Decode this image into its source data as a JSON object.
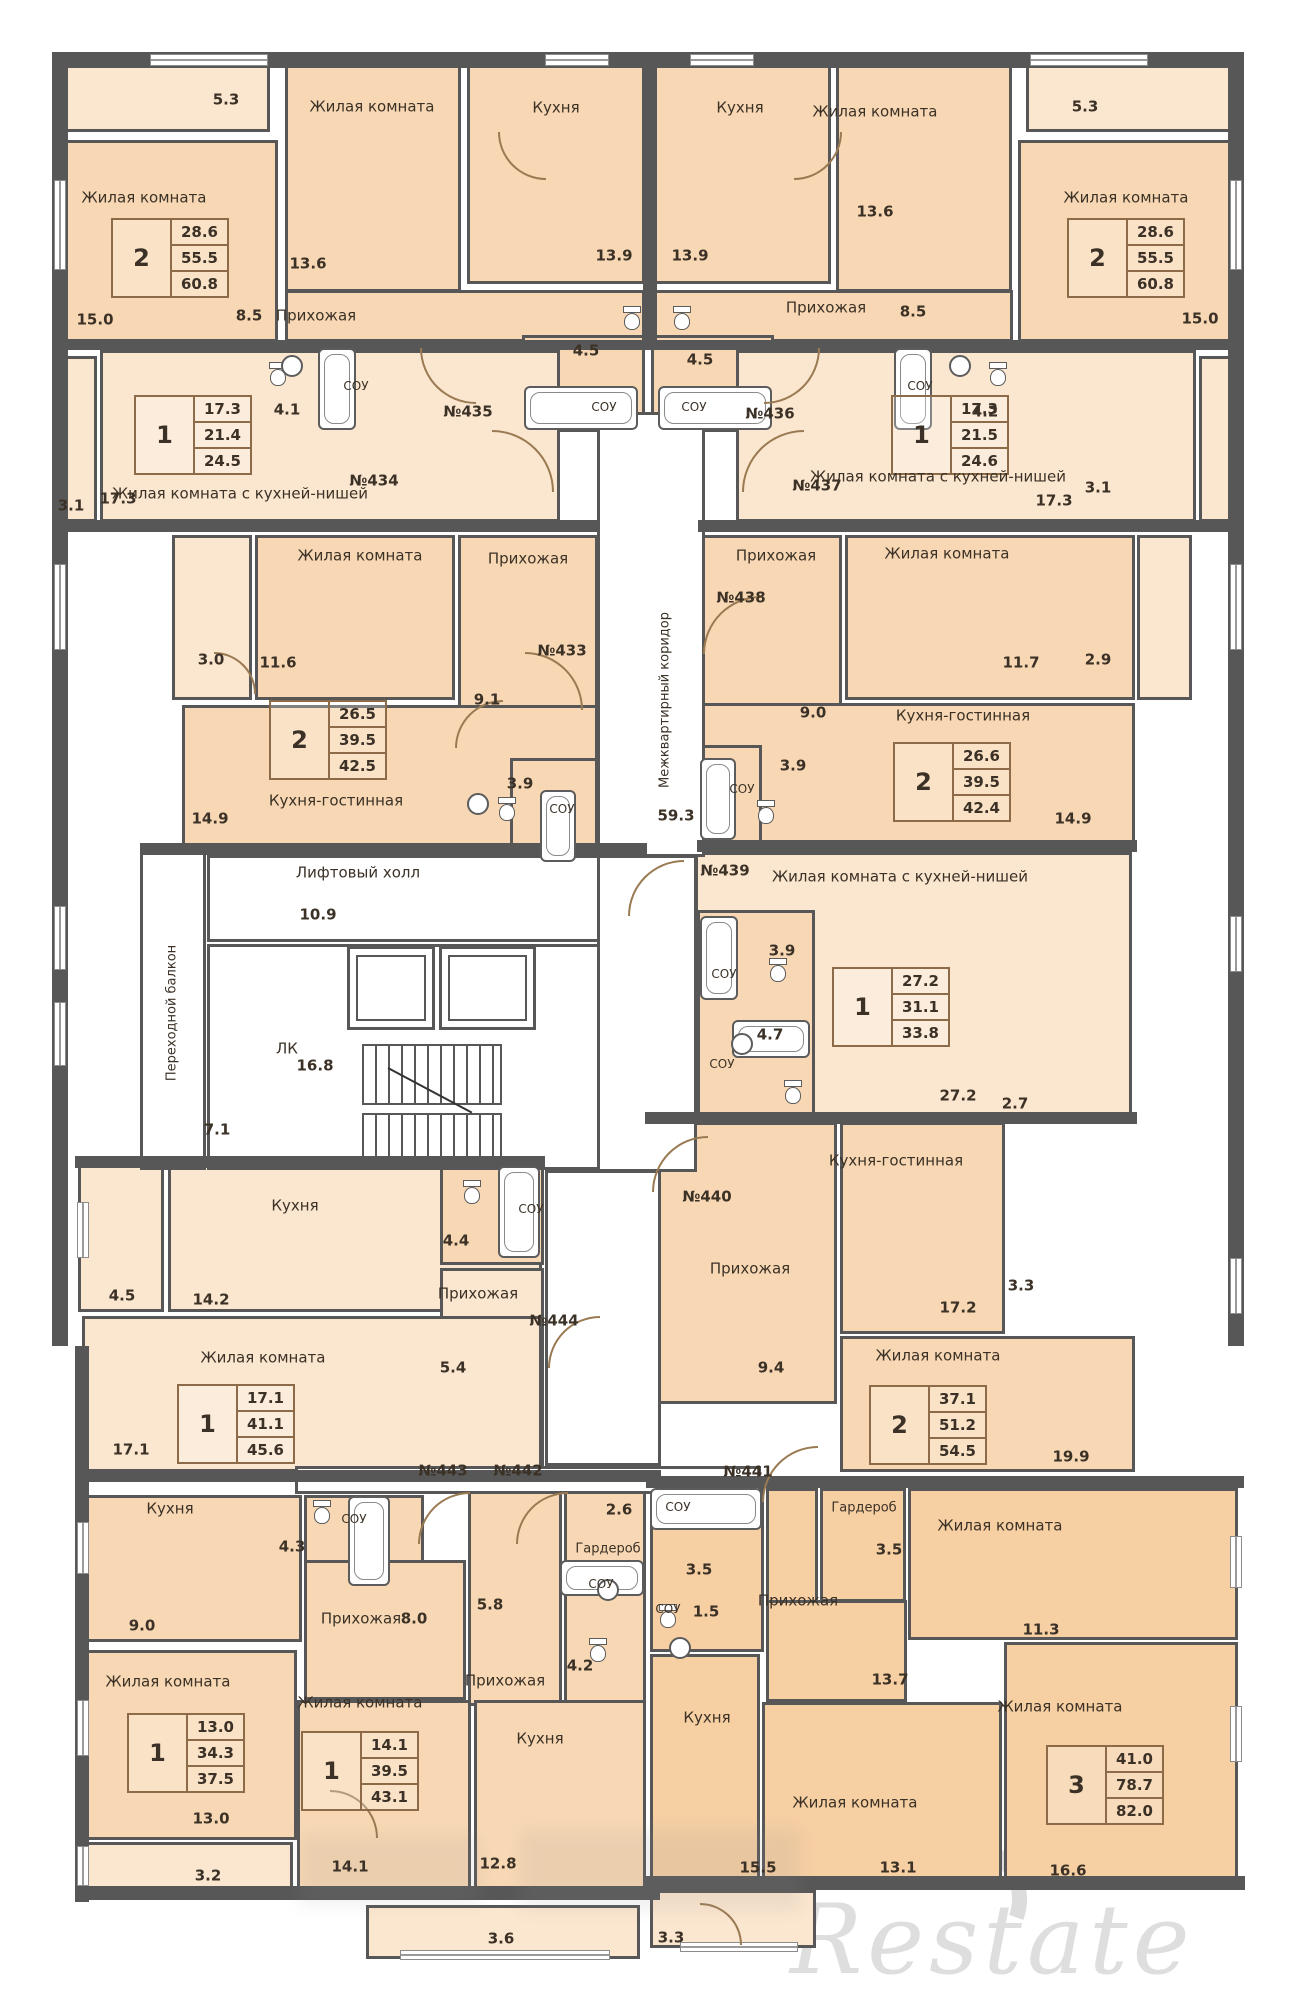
{
  "watermark": {
    "text": "Restate"
  },
  "palette": {
    "room_standard": "#f8d8b4",
    "room_light": "#fbe6cf",
    "room_dark": "#f6cfa3",
    "wall": "#575757",
    "text": "#3b3126",
    "table_border": "#8d6b49",
    "door_arc": "#9a7a52"
  },
  "rooms": [
    [
      "balcony-435",
      62,
      62,
      208,
      70,
      "b"
    ],
    [
      "living2-435",
      62,
      140,
      216,
      202,
      "a"
    ],
    [
      "living-435",
      285,
      62,
      176,
      230,
      "a"
    ],
    [
      "kitchen-435",
      467,
      62,
      178,
      222,
      "a"
    ],
    [
      "hallway-435",
      285,
      290,
      360,
      52,
      "a"
    ],
    [
      "wc-435",
      250,
      348,
      68,
      84,
      "a"
    ],
    [
      "sou-435",
      318,
      348,
      84,
      84,
      "a"
    ],
    [
      "lobby-435",
      402,
      348,
      120,
      84,
      "a"
    ],
    [
      "sou45-435",
      522,
      335,
      123,
      97,
      "a"
    ],
    [
      "kitchen-436",
      653,
      62,
      178,
      222,
      "a"
    ],
    [
      "living-436",
      836,
      62,
      176,
      230,
      "a"
    ],
    [
      "balcony-436",
      1026,
      62,
      208,
      70,
      "b"
    ],
    [
      "living2-436",
      1018,
      140,
      216,
      202,
      "a"
    ],
    [
      "hallway-436",
      653,
      290,
      360,
      52,
      "a"
    ],
    [
      "sou45-436",
      651,
      335,
      123,
      97,
      "a"
    ],
    [
      "lobby-436",
      774,
      348,
      120,
      84,
      "a"
    ],
    [
      "sou-436",
      894,
      348,
      84,
      84,
      "a"
    ],
    [
      "wc-436",
      978,
      348,
      68,
      84,
      "a"
    ],
    [
      "balcony-434",
      55,
      356,
      42,
      166,
      "b"
    ],
    [
      "main-434",
      100,
      350,
      460,
      172,
      "b"
    ],
    [
      "main-437",
      736,
      350,
      460,
      172,
      "b"
    ],
    [
      "balcony-437",
      1199,
      356,
      42,
      166,
      "b"
    ],
    [
      "balcony-433",
      172,
      535,
      80,
      165,
      "b"
    ],
    [
      "living-433",
      255,
      535,
      200,
      165,
      "a"
    ],
    [
      "hallway-433",
      458,
      535,
      140,
      185,
      "a"
    ],
    [
      "kitchenliving-433",
      182,
      705,
      416,
      145,
      "a"
    ],
    [
      "sou-433",
      510,
      758,
      88,
      92,
      "a"
    ],
    [
      "hallway-438",
      700,
      535,
      142,
      185,
      "a"
    ],
    [
      "living-438",
      845,
      535,
      290,
      165,
      "a"
    ],
    [
      "balcony-438",
      1137,
      535,
      55,
      165,
      "b"
    ],
    [
      "kitchenliving-438",
      700,
      703,
      435,
      140,
      "a"
    ],
    [
      "sou-438",
      700,
      745,
      62,
      100,
      "a"
    ],
    [
      "main-439",
      695,
      852,
      437,
      265,
      "b"
    ],
    [
      "souzone-439",
      697,
      910,
      118,
      207,
      "a"
    ],
    [
      "hallway-440",
      650,
      1122,
      187,
      282,
      "a"
    ],
    [
      "kitchenliving-440",
      840,
      1122,
      165,
      212,
      "a"
    ],
    [
      "living-440",
      840,
      1336,
      295,
      136,
      "a"
    ],
    [
      "balcony-444",
      78,
      1165,
      86,
      147,
      "b"
    ],
    [
      "kitchen-444",
      168,
      1165,
      374,
      147,
      "b"
    ],
    [
      "sou-444",
      440,
      1165,
      104,
      100,
      "a"
    ],
    [
      "hallway-444",
      440,
      1268,
      104,
      200,
      "b"
    ],
    [
      "living-444",
      82,
      1316,
      460,
      156,
      "b"
    ],
    [
      "kitchen-443",
      85,
      1495,
      217,
      147,
      "a"
    ],
    [
      "wcsou-443",
      304,
      1495,
      120,
      147,
      "a"
    ],
    [
      "hallway-443",
      304,
      1560,
      162,
      140,
      "a"
    ],
    [
      "living-443",
      85,
      1650,
      212,
      190,
      "a"
    ],
    [
      "balcony-443",
      80,
      1842,
      213,
      52,
      "b"
    ],
    [
      "hallway-442",
      468,
      1490,
      94,
      216,
      "a"
    ],
    [
      "wardrobe-442",
      564,
      1490,
      82,
      216,
      "a"
    ],
    [
      "living-442",
      297,
      1700,
      174,
      196,
      "a"
    ],
    [
      "kitchen-442",
      474,
      1700,
      172,
      196,
      "a"
    ],
    [
      "balcony-442",
      366,
      1905,
      274,
      54,
      "b"
    ],
    [
      "sou-441",
      650,
      1488,
      114,
      164,
      "c"
    ],
    [
      "hallwayA-441",
      766,
      1488,
      52,
      214,
      "c"
    ],
    [
      "wardrobe-441",
      820,
      1488,
      86,
      114,
      "c"
    ],
    [
      "hallwayB-441",
      766,
      1600,
      141,
      102,
      "c"
    ],
    [
      "living113-441",
      908,
      1488,
      330,
      152,
      "c"
    ],
    [
      "living166-441",
      1004,
      1642,
      234,
      244,
      "c"
    ],
    [
      "kitchen-441",
      650,
      1654,
      110,
      232,
      "c"
    ],
    [
      "living131-441",
      762,
      1702,
      240,
      184,
      "c"
    ],
    [
      "balcony-441",
      650,
      1890,
      166,
      58,
      "b"
    ]
  ],
  "whites": [
    [
      "elevator-hall",
      207,
      855,
      440,
      87
    ],
    [
      "stair-room",
      207,
      944,
      440,
      226
    ],
    [
      "transfer-balcony",
      140,
      852,
      66,
      318
    ],
    [
      "corridor-top",
      597,
      412,
      108,
      445
    ],
    [
      "corridor-mid",
      597,
      855,
      100,
      317
    ],
    [
      "corridor-low",
      545,
      1170,
      116,
      296
    ],
    [
      "corridor-strip",
      295,
      1466,
      466,
      28
    ]
  ],
  "walls": [
    [
      52,
      52,
      1192,
      16
    ],
    [
      52,
      52,
      16,
      1294
    ],
    [
      1228,
      52,
      16,
      1294
    ],
    [
      75,
      1346,
      14,
      556
    ],
    [
      75,
      1886,
      585,
      14
    ],
    [
      646,
      1876,
      599,
      14
    ],
    [
      643,
      52,
      14,
      290
    ],
    [
      52,
      340,
      1192,
      10
    ],
    [
      55,
      520,
      545,
      12
    ],
    [
      698,
      520,
      546,
      12
    ],
    [
      140,
      843,
      507,
      12
    ],
    [
      697,
      840,
      440,
      12
    ],
    [
      645,
      1112,
      492,
      12
    ],
    [
      75,
      1156,
      470,
      12
    ],
    [
      75,
      1470,
      586,
      12
    ],
    [
      646,
      1476,
      598,
      12
    ]
  ],
  "windows": [
    [
      150,
      54,
      118,
      12,
      "h"
    ],
    [
      545,
      54,
      64,
      12,
      "h"
    ],
    [
      690,
      54,
      64,
      12,
      "h"
    ],
    [
      1030,
      54,
      118,
      12,
      "h"
    ],
    [
      54,
      180,
      12,
      90,
      "v"
    ],
    [
      54,
      564,
      12,
      86,
      "v"
    ],
    [
      54,
      906,
      12,
      64,
      "v"
    ],
    [
      54,
      1002,
      12,
      64,
      "v"
    ],
    [
      77,
      1202,
      12,
      56,
      "v"
    ],
    [
      77,
      1522,
      12,
      52,
      "v"
    ],
    [
      77,
      1700,
      12,
      56,
      "v"
    ],
    [
      77,
      1846,
      12,
      40,
      "v"
    ],
    [
      1230,
      180,
      12,
      90,
      "v"
    ],
    [
      1230,
      564,
      12,
      86,
      "v"
    ],
    [
      1230,
      916,
      12,
      56,
      "v"
    ],
    [
      1230,
      1258,
      12,
      56,
      "v"
    ],
    [
      1230,
      1536,
      12,
      52,
      "v"
    ],
    [
      1230,
      1706,
      12,
      56,
      "v"
    ],
    [
      400,
      1950,
      210,
      10,
      "h"
    ],
    [
      680,
      1942,
      118,
      10,
      "h"
    ]
  ],
  "labels": [
    [
      "5.3",
      226,
      100
    ],
    [
      "Жилая комната",
      372,
      107
    ],
    [
      "Кухня",
      556,
      108
    ],
    [
      "Жилая комната",
      144,
      198
    ],
    [
      "13.6",
      308,
      264
    ],
    [
      "13.9",
      614,
      256
    ],
    [
      "15.0",
      95,
      320
    ],
    [
      "8.5",
      249,
      316
    ],
    [
      "Прихожая",
      316,
      316
    ],
    [
      "4.5",
      586,
      351
    ],
    [
      "4.1",
      287,
      410
    ],
    [
      "СОУ",
      356,
      386,
      12
    ],
    [
      "СОУ",
      604,
      407,
      12
    ],
    [
      "№435",
      468,
      412
    ],
    [
      "5.3",
      1085,
      107
    ],
    [
      "Кухня",
      740,
      108
    ],
    [
      "Жилая комната",
      875,
      112
    ],
    [
      "Жилая комната",
      1126,
      198
    ],
    [
      "13.9",
      690,
      256
    ],
    [
      "13.6",
      875,
      212
    ],
    [
      "15.0",
      1200,
      319
    ],
    [
      "Прихожая",
      826,
      308
    ],
    [
      "8.5",
      913,
      312
    ],
    [
      "4.5",
      700,
      360
    ],
    [
      "СОУ",
      694,
      407,
      12
    ],
    [
      "№436",
      770,
      414
    ],
    [
      "СОУ",
      920,
      386,
      12
    ],
    [
      "4.2",
      985,
      412
    ],
    [
      "17.3",
      118,
      499
    ],
    [
      "Жилая комната с кухней-нишей",
      240,
      494
    ],
    [
      "3.1",
      71,
      506
    ],
    [
      "№434",
      374,
      481
    ],
    [
      "Жилая комната с кухней-нишей",
      938,
      477
    ],
    [
      "17.3",
      1054,
      501
    ],
    [
      "3.1",
      1098,
      488
    ],
    [
      "№437",
      817,
      486
    ],
    [
      "Жилая комната",
      360,
      556
    ],
    [
      "Прихожая",
      528,
      559
    ],
    [
      "3.0",
      211,
      660
    ],
    [
      "11.6",
      278,
      663
    ],
    [
      "№433",
      562,
      651
    ],
    [
      "9.1",
      487,
      700
    ],
    [
      "Кухня-гостинная",
      336,
      801
    ],
    [
      "14.9",
      210,
      819
    ],
    [
      "3.9",
      520,
      784
    ],
    [
      "СОУ",
      562,
      809,
      12
    ],
    [
      "Прихожая",
      776,
      556
    ],
    [
      "Жилая комната",
      947,
      554
    ],
    [
      "№438",
      741,
      598
    ],
    [
      "11.7",
      1021,
      663
    ],
    [
      "2.9",
      1098,
      660
    ],
    [
      "9.0",
      813,
      713
    ],
    [
      "Кухня-гостинная",
      963,
      716
    ],
    [
      "3.9",
      793,
      766
    ],
    [
      "СОУ",
      742,
      789,
      12
    ],
    [
      "14.9",
      1073,
      819
    ],
    [
      "Лифтовый холл",
      358,
      873
    ],
    [
      "10.9",
      318,
      915
    ],
    [
      "Переходной балкон",
      172,
      1013,
      13,
      -90
    ],
    [
      "ЛК",
      287,
      1049
    ],
    [
      "16.8",
      315,
      1066
    ],
    [
      "7.1",
      217,
      1130
    ],
    [
      "Межквартирный коридор",
      665,
      700,
      13,
      -90
    ],
    [
      "59.3",
      676,
      816
    ],
    [
      "№439",
      725,
      871
    ],
    [
      "Жилая комната с кухней-нишей",
      900,
      877
    ],
    [
      "3.9",
      782,
      951
    ],
    [
      "СОУ",
      724,
      974,
      12
    ],
    [
      "4.7",
      770,
      1035
    ],
    [
      "СОУ",
      722,
      1064,
      12
    ],
    [
      "27.2",
      958,
      1096
    ],
    [
      "2.7",
      1015,
      1104
    ],
    [
      "№440",
      707,
      1197
    ],
    [
      "Кухня-гостинная",
      896,
      1161
    ],
    [
      "Прихожая",
      750,
      1269
    ],
    [
      "3.3",
      1021,
      1286
    ],
    [
      "17.2",
      958,
      1308
    ],
    [
      "9.4",
      771,
      1368
    ],
    [
      "Жилая комната",
      938,
      1356
    ],
    [
      "19.9",
      1071,
      1457
    ],
    [
      "Кухня",
      295,
      1206
    ],
    [
      "4.5",
      122,
      1296
    ],
    [
      "14.2",
      211,
      1300
    ],
    [
      "4.4",
      456,
      1241
    ],
    [
      "СОУ",
      531,
      1209,
      12
    ],
    [
      "Прихожая",
      478,
      1294
    ],
    [
      "№444",
      554,
      1321
    ],
    [
      "5.4",
      453,
      1368
    ],
    [
      "Жилая комната",
      263,
      1358
    ],
    [
      "17.1",
      131,
      1450
    ],
    [
      "№443",
      443,
      1471
    ],
    [
      "№442",
      518,
      1471
    ],
    [
      "№441",
      748,
      1472
    ],
    [
      "Кухня",
      170,
      1509
    ],
    [
      "4.3",
      292,
      1547
    ],
    [
      "СОУ",
      354,
      1519,
      12
    ],
    [
      "9.0",
      142,
      1626
    ],
    [
      "Прихожая",
      361,
      1619
    ],
    [
      "8.0",
      414,
      1619
    ],
    [
      "Жилая комната",
      168,
      1682
    ],
    [
      "13.0",
      211,
      1819
    ],
    [
      "3.2",
      208,
      1876
    ],
    [
      "2.6",
      619,
      1510
    ],
    [
      "Гардероб",
      608,
      1549,
      13
    ],
    [
      "СОУ",
      601,
      1584,
      12
    ],
    [
      "5.8",
      490,
      1605
    ],
    [
      "4.2",
      580,
      1666
    ],
    [
      "Прихожая",
      505,
      1681
    ],
    [
      "Жилая комната",
      360,
      1703
    ],
    [
      "Кухня",
      540,
      1739
    ],
    [
      "14.1",
      350,
      1867
    ],
    [
      "12.8",
      498,
      1864
    ],
    [
      "3.6",
      501,
      1939
    ],
    [
      "СОУ",
      678,
      1507,
      12
    ],
    [
      "3.5",
      699,
      1570
    ],
    [
      "Гардероб",
      864,
      1508,
      13
    ],
    [
      "3.5",
      889,
      1550
    ],
    [
      "Жилая комната",
      1000,
      1526
    ],
    [
      "11.3",
      1041,
      1630
    ],
    [
      "СОУ",
      668,
      1609,
      12
    ],
    [
      "1.5",
      706,
      1612
    ],
    [
      "Прихожая",
      798,
      1601
    ],
    [
      "13.7",
      890,
      1680
    ],
    [
      "Кухня",
      707,
      1718
    ],
    [
      "Жилая комната",
      855,
      1803
    ],
    [
      "13.1",
      898,
      1868
    ],
    [
      "Жилая комната",
      1060,
      1707
    ],
    [
      "16.6",
      1068,
      1871
    ],
    [
      "15.5",
      758,
      1868
    ],
    [
      "3.3",
      671,
      1938
    ]
  ],
  "tables": [
    [
      170,
      258,
      "2",
      "28.6",
      "55.5",
      "60.8"
    ],
    [
      1126,
      258,
      "2",
      "28.6",
      "55.5",
      "60.8"
    ],
    [
      193,
      435,
      "1",
      "17.3",
      "21.4",
      "24.5"
    ],
    [
      950,
      435,
      "1",
      "17.3",
      "21.5",
      "24.6"
    ],
    [
      328,
      740,
      "2",
      "26.5",
      "39.5",
      "42.5"
    ],
    [
      952,
      782,
      "2",
      "26.6",
      "39.5",
      "42.4"
    ],
    [
      891,
      1007,
      "1",
      "27.2",
      "31.1",
      "33.8"
    ],
    [
      928,
      1425,
      "2",
      "37.1",
      "51.2",
      "54.5"
    ],
    [
      236,
      1424,
      "1",
      "17.1",
      "41.1",
      "45.6"
    ],
    [
      186,
      1753,
      "1",
      "13.0",
      "34.3",
      "37.5"
    ],
    [
      360,
      1771,
      "1",
      "14.1",
      "39.5",
      "43.1"
    ],
    [
      1105,
      1785,
      "3",
      "41.0",
      "78.7",
      "82.0"
    ]
  ],
  "doors": [
    [
      420,
      348,
      56,
      "bl"
    ],
    [
      764,
      348,
      56,
      "br"
    ],
    [
      492,
      430,
      62,
      "tr"
    ],
    [
      742,
      430,
      62,
      "tl"
    ],
    [
      525,
      652,
      58,
      "tr"
    ],
    [
      703,
      596,
      58,
      "tl"
    ],
    [
      628,
      860,
      56,
      "tl"
    ],
    [
      652,
      1136,
      56,
      "tl"
    ],
    [
      762,
      1446,
      56,
      "tl"
    ],
    [
      516,
      1492,
      52,
      "tl"
    ],
    [
      418,
      1492,
      52,
      "tl"
    ],
    [
      548,
      1316,
      52,
      "tl"
    ],
    [
      498,
      132,
      48,
      "bl"
    ],
    [
      794,
      132,
      48,
      "br"
    ],
    [
      214,
      652,
      42,
      "tr"
    ],
    [
      330,
      1790,
      48,
      "tr"
    ],
    [
      700,
      1903,
      42,
      "tr"
    ],
    [
      455,
      700,
      48,
      "tl"
    ]
  ],
  "baths": [
    [
      318,
      348,
      38,
      82
    ],
    [
      894,
      348,
      38,
      82
    ],
    [
      524,
      386,
      114,
      44
    ],
    [
      658,
      386,
      114,
      44
    ],
    [
      540,
      790,
      36,
      72
    ],
    [
      700,
      758,
      36,
      82
    ],
    [
      700,
      916,
      38,
      84
    ],
    [
      732,
      1020,
      78,
      38
    ],
    [
      498,
      1166,
      42,
      92
    ],
    [
      348,
      1496,
      42,
      90
    ],
    [
      560,
      1560,
      84,
      36
    ],
    [
      650,
      1488,
      112,
      42
    ]
  ],
  "toilets": [
    [
      268,
      362
    ],
    [
      988,
      362
    ],
    [
      622,
      306
    ],
    [
      672,
      306
    ],
    [
      497,
      797
    ],
    [
      756,
      800
    ],
    [
      768,
      958
    ],
    [
      783,
      1080
    ],
    [
      462,
      1180
    ],
    [
      312,
      1500
    ],
    [
      588,
      1638
    ],
    [
      658,
      1604
    ]
  ],
  "sinks": [
    [
      292,
      366
    ],
    [
      960,
      366
    ],
    [
      478,
      804
    ],
    [
      742,
      1044
    ],
    [
      608,
      1590
    ],
    [
      680,
      1648
    ]
  ],
  "elevators": [
    [
      347,
      946,
      88,
      84
    ],
    [
      439,
      946,
      97,
      84
    ]
  ],
  "stairs": [
    362,
    1044,
    140,
    122
  ],
  "blobs": [
    [
      520,
      1830,
      280,
      80
    ],
    [
      300,
      1835,
      180,
      70
    ]
  ]
}
